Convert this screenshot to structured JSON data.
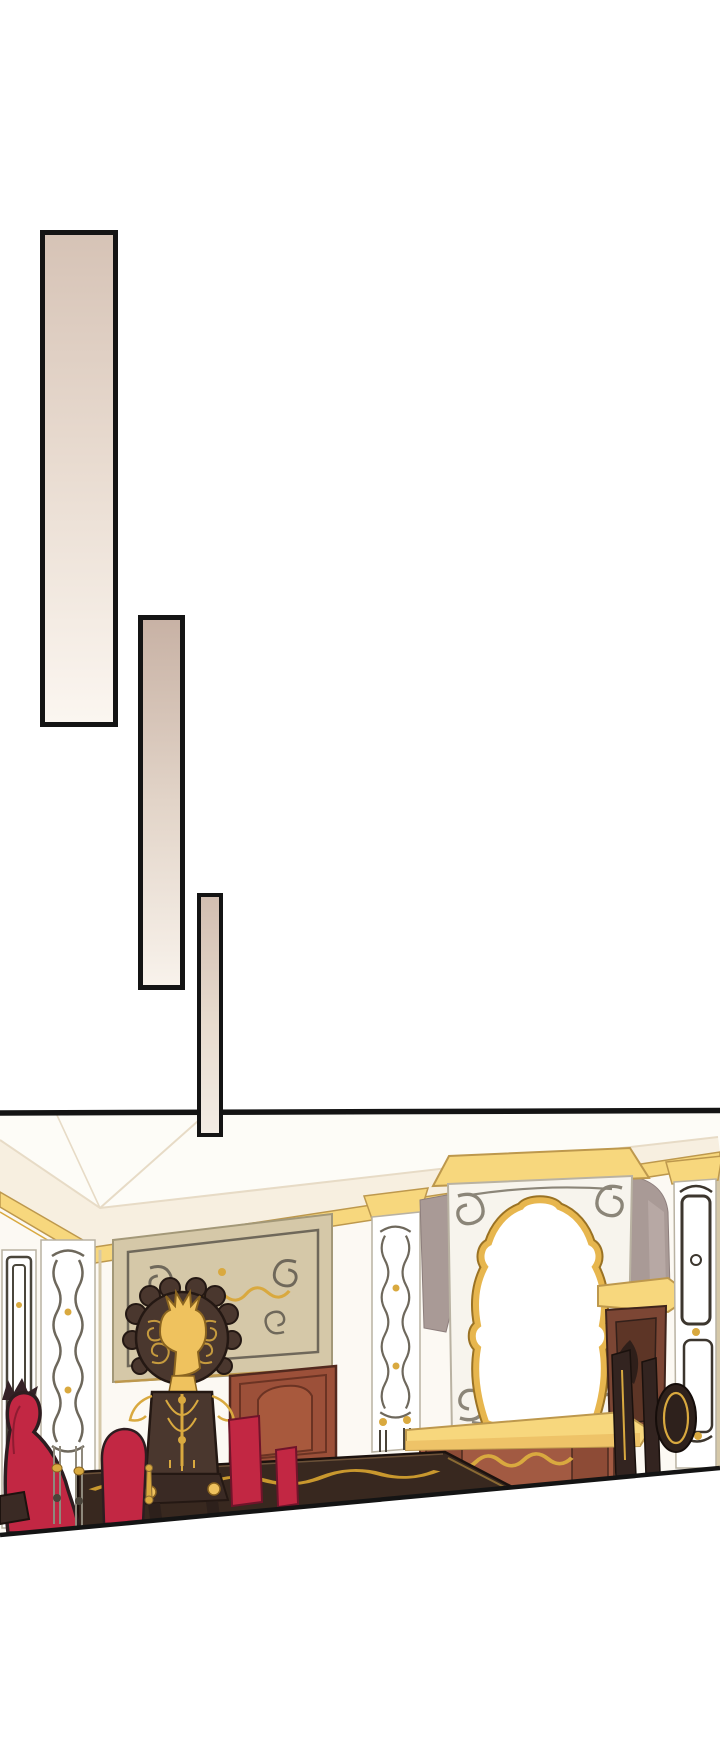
{
  "page": {
    "kind": "webtoon-manhwa-page",
    "background": "#ffffff",
    "width_px": 720,
    "height_px": 1750,
    "description": "Manhwa page segment: three tall black-bordered beige gradient transition panels staggered diagonally over white space, above a wide illustrated panel of an ornate palace dining hall, whose bottom edge is cut on a diagonal."
  },
  "panels": [
    {
      "name": "transition-panel-1",
      "shape": "tall-rectangle",
      "border_color": "#141414",
      "gradient_top": "#d6c3b6",
      "gradient_bottom": "#fbf6f0"
    },
    {
      "name": "transition-panel-2",
      "shape": "tall-rectangle",
      "border_color": "#141414",
      "gradient_top": "#c8b2a5",
      "gradient_bottom": "#f8f2eb"
    },
    {
      "name": "transition-panel-3",
      "shape": "tall-rectangle",
      "border_color": "#141414",
      "gradient_top": "#d2beb1",
      "gradient_bottom": "#f3ece4"
    }
  ],
  "scene": {
    "name": "dining-hall-illustration",
    "description": "Ornate palace dining hall: white coved ceiling with gold cornice, cream walls with filigree pilasters and tan ornamental panels, a large gilt baroque mirror over a yellow mantel and maroon fireplace, a carved dark high-back chair with a gold crest, crimson upholstered chairs, a reddish carved door and a long dark banquet table trimmed with gold scrollwork; the panel ends on a rising diagonal cut.",
    "elements": [
      "ceiling",
      "gold-cornice",
      "left-meander-panel",
      "filigree-pilasters",
      "ornate-wall-panel",
      "carved-door",
      "baroque-mirror",
      "wall-drapes",
      "gilded-sideboard",
      "mantel-shelf",
      "fireplace",
      "high-back-chair",
      "red-chairs",
      "banquet-table",
      "diagonal-cut-edge"
    ]
  },
  "palette": {
    "ink": "#141414",
    "bar1-top": "#d6c3b6",
    "bar1-mid": "#e9dcd1",
    "bar1-bottom": "#fbf6f0",
    "bar2-top": "#c8b2a5",
    "bar2-mid": "#e2d4c8",
    "bar2-bottom": "#f8f2eb",
    "bar3-top": "#d2beb1",
    "bar3-mid": "#e8dccf",
    "bar3-bottom": "#f3ece4",
    "ceiling": "#fdfcf7",
    "cream": "#f7efe0",
    "cove-line": "#e7dbc6",
    "wall": "#fcf9f3",
    "gold": "#f7d77d",
    "gold-line": "#bd984d",
    "gold-deep": "#d9a93f",
    "gold-mirror": "#e7b64e",
    "gold-emblem": "#efc25e",
    "tan": "#d5c8a8",
    "tan-line": "#a39878",
    "frame": "#6f685a",
    "panel-line": "#b9b2a2",
    "filigree": "#6e685c",
    "silver": "#8f897c",
    "mauve": "#a99a96",
    "mauve-light": "#b7a8a4",
    "maroon": "#a25a42",
    "maroon-dark": "#8d4b36",
    "door": "#9c5039",
    "wood": "#4a372e",
    "wood-deep": "#241813",
    "table": "#38281f",
    "red": "#c22743",
    "red-dark": "#2d1d20"
  }
}
